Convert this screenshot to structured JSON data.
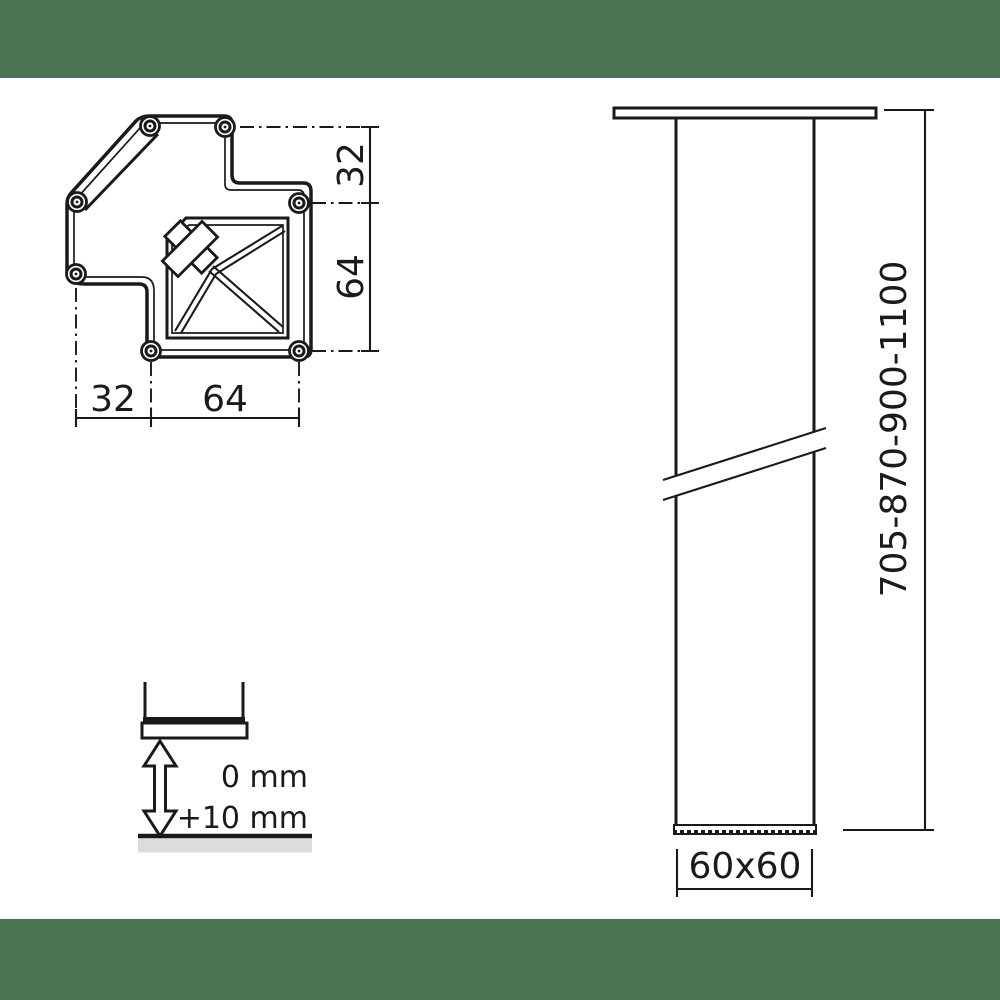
{
  "colors": {
    "accent_green": "#4a7351",
    "line": "#1a1a1a",
    "ground_gray": "#dcdcdc",
    "background": "#ffffff"
  },
  "top_view": {
    "dim_right_top": "32",
    "dim_right_bottom": "64",
    "dim_bottom_left": "32",
    "dim_bottom_right": "64"
  },
  "side_view": {
    "height_range": "705-870-900-1100",
    "cross_section": "60x60"
  },
  "adjustment_detail": {
    "min_label": "0 mm",
    "max_label": "+10 mm"
  }
}
